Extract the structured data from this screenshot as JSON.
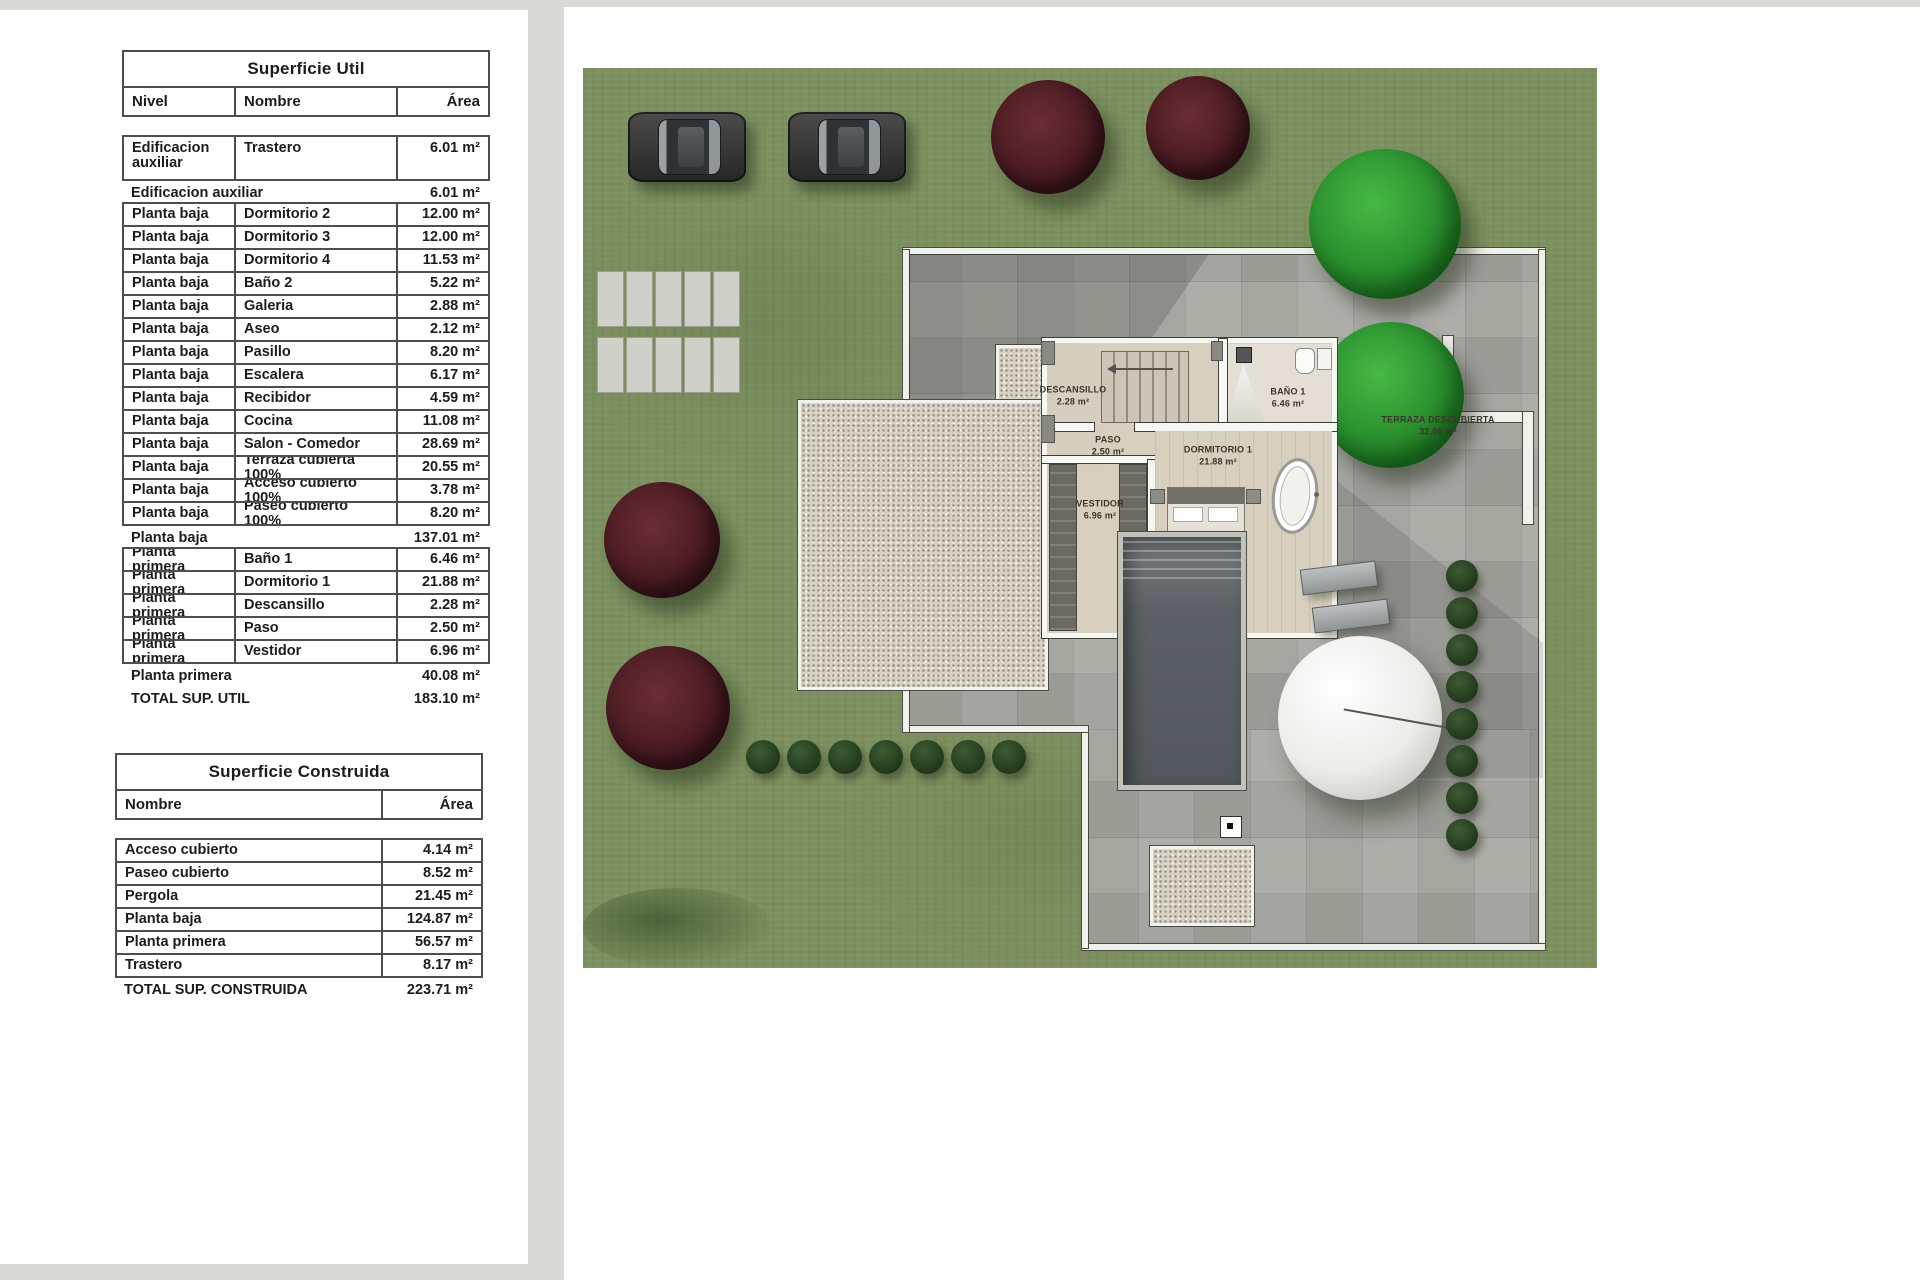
{
  "superficie_util": {
    "title": "Superficie Util",
    "columns": {
      "nivel": "Nivel",
      "nombre": "Nombre",
      "area": "Área"
    },
    "rows": [
      {
        "type": "item",
        "tall": true,
        "nivel": "Edificacion auxiliar",
        "nombre": "Trastero",
        "area": "6.01 m²"
      },
      {
        "type": "subtotal",
        "label": "Edificacion auxiliar",
        "area": "6.01 m²"
      },
      {
        "type": "item",
        "nivel": "Planta baja",
        "nombre": "Dormitorio 2",
        "area": "12.00 m²"
      },
      {
        "type": "item",
        "nivel": "Planta baja",
        "nombre": "Dormitorio 3",
        "area": "12.00 m²"
      },
      {
        "type": "item",
        "nivel": "Planta baja",
        "nombre": "Dormitorio 4",
        "area": "11.53 m²"
      },
      {
        "type": "item",
        "nivel": "Planta baja",
        "nombre": "Baño 2",
        "area": "5.22 m²"
      },
      {
        "type": "item",
        "nivel": "Planta baja",
        "nombre": "Galeria",
        "area": "2.88 m²"
      },
      {
        "type": "item",
        "nivel": "Planta baja",
        "nombre": "Aseo",
        "area": "2.12 m²"
      },
      {
        "type": "item",
        "nivel": "Planta baja",
        "nombre": "Pasillo",
        "area": "8.20 m²"
      },
      {
        "type": "item",
        "nivel": "Planta baja",
        "nombre": "Escalera",
        "area": "6.17 m²"
      },
      {
        "type": "item",
        "nivel": "Planta baja",
        "nombre": "Recibidor",
        "area": "4.59 m²"
      },
      {
        "type": "item",
        "nivel": "Planta baja",
        "nombre": "Cocina",
        "area": "11.08 m²"
      },
      {
        "type": "item",
        "nivel": "Planta baja",
        "nombre": "Salon - Comedor",
        "area": "28.69 m²"
      },
      {
        "type": "item",
        "nivel": "Planta baja",
        "nombre": "Terraza cubierta 100%",
        "area": "20.55 m²"
      },
      {
        "type": "item",
        "nivel": "Planta baja",
        "nombre": "Acceso cubierto 100%",
        "area": "3.78 m²"
      },
      {
        "type": "item",
        "nivel": "Planta baja",
        "nombre": "Paseo cubierto 100%",
        "area": "8.20 m²"
      },
      {
        "type": "subtotal",
        "label": "Planta baja",
        "area": "137.01 m²"
      },
      {
        "type": "item",
        "nivel": "Planta primera",
        "nombre": "Baño 1",
        "area": "6.46 m²"
      },
      {
        "type": "item",
        "nivel": "Planta primera",
        "nombre": "Dormitorio 1",
        "area": "21.88 m²"
      },
      {
        "type": "item",
        "nivel": "Planta primera",
        "nombre": "Descansillo",
        "area": "2.28 m²"
      },
      {
        "type": "item",
        "nivel": "Planta primera",
        "nombre": "Paso",
        "area": "2.50 m²"
      },
      {
        "type": "item",
        "nivel": "Planta primera",
        "nombre": "Vestidor",
        "area": "6.96 m²"
      },
      {
        "type": "subtotal",
        "label": "Planta primera",
        "area": "40.08 m²"
      },
      {
        "type": "total",
        "label": "TOTAL SUP. UTIL",
        "area": "183.10 m²"
      }
    ]
  },
  "superficie_construida": {
    "title": "Superficie Construida",
    "columns": {
      "nombre": "Nombre",
      "area": "Área"
    },
    "rows": [
      {
        "type": "item",
        "nombre": "Acceso cubierto",
        "area": "4.14 m²"
      },
      {
        "type": "item",
        "nombre": "Paseo cubierto",
        "area": "8.52 m²"
      },
      {
        "type": "item",
        "nombre": "Pergola",
        "area": "21.45 m²"
      },
      {
        "type": "item",
        "nombre": "Planta baja",
        "area": "124.87 m²"
      },
      {
        "type": "item",
        "nombre": "Planta primera",
        "area": "56.57 m²"
      },
      {
        "type": "item",
        "nombre": "Trastero",
        "area": "8.17 m²"
      },
      {
        "type": "total",
        "label": "TOTAL SUP. CONSTRUIDA",
        "area": "223.71 m²"
      }
    ]
  },
  "site_plan": {
    "rooms": [
      {
        "name": "DESCANSILLO",
        "area": "2.28 m²"
      },
      {
        "name": "PASO",
        "area": "2.50 m²"
      },
      {
        "name": "BAÑO 1",
        "area": "6.46 m²"
      },
      {
        "name": "DORMITORIO 1",
        "area": "21.88 m²"
      },
      {
        "name": "VESTIDOR",
        "area": "6.96 m²"
      },
      {
        "name": "TERRAZA DESCUBIERTA",
        "area": "32.00 m²"
      }
    ],
    "colors": {
      "grass": "#7d9160",
      "paving": "#a8a8a3",
      "wall_white": "#f1f1ec",
      "pool": "#5c6165",
      "tree_dark_red": "#4e1d24",
      "tree_green": "#2fa135",
      "gravel": "#d8d2c5"
    }
  }
}
